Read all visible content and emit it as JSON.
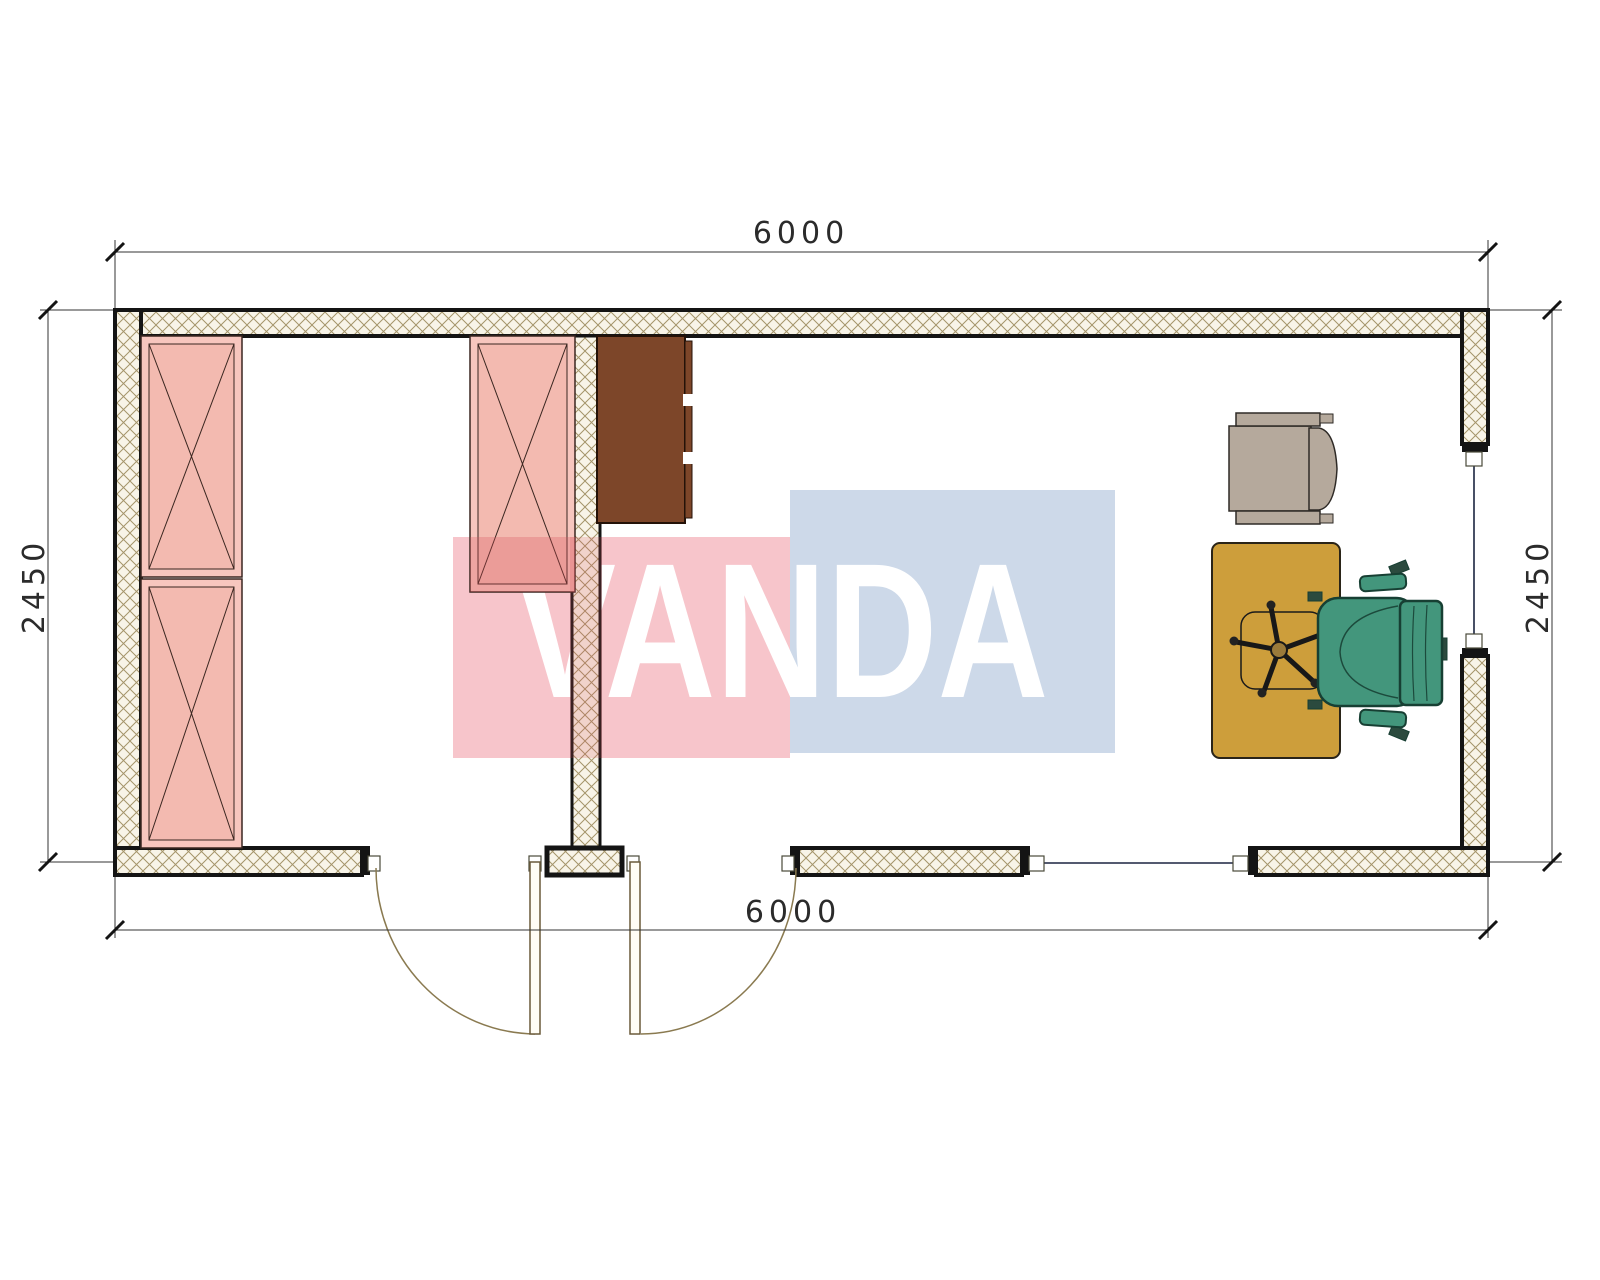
{
  "document": {
    "type": "architectural-floor-plan",
    "module_size": "6000 x 2450"
  },
  "dimensions": {
    "top_width_mm": "6000",
    "bottom_width_mm": "6000",
    "left_height_mm": "2450",
    "right_height_mm": "2450",
    "label_color": "#2b2b2b"
  },
  "watermark": {
    "text": "VANDA",
    "text_color": "#ffffff",
    "red_block_color": "#f7c5cb",
    "blue_block_color": "#cdd9e9",
    "overlay_tint": "#d94f58"
  },
  "plan": {
    "wall_fill": "#f8f4e8",
    "wall_hatch_line": "#a4946a",
    "wall_outline": "#141414",
    "door_arc_color": "#8a7a50",
    "door_leaf_fill": "#fffdf6",
    "glass_color": "#1b2440"
  },
  "furniture": {
    "wardrobe_fill": "#f7c6be",
    "wardrobe_inner_fill": "#f3bab0",
    "wardrobe_outline": "#3a2620",
    "cabinet_fill": "#7d4629",
    "desk_fill": "#cd9e3b",
    "office_chair_fill": "#43967c",
    "guest_chair_fill": "#b5a99c"
  }
}
